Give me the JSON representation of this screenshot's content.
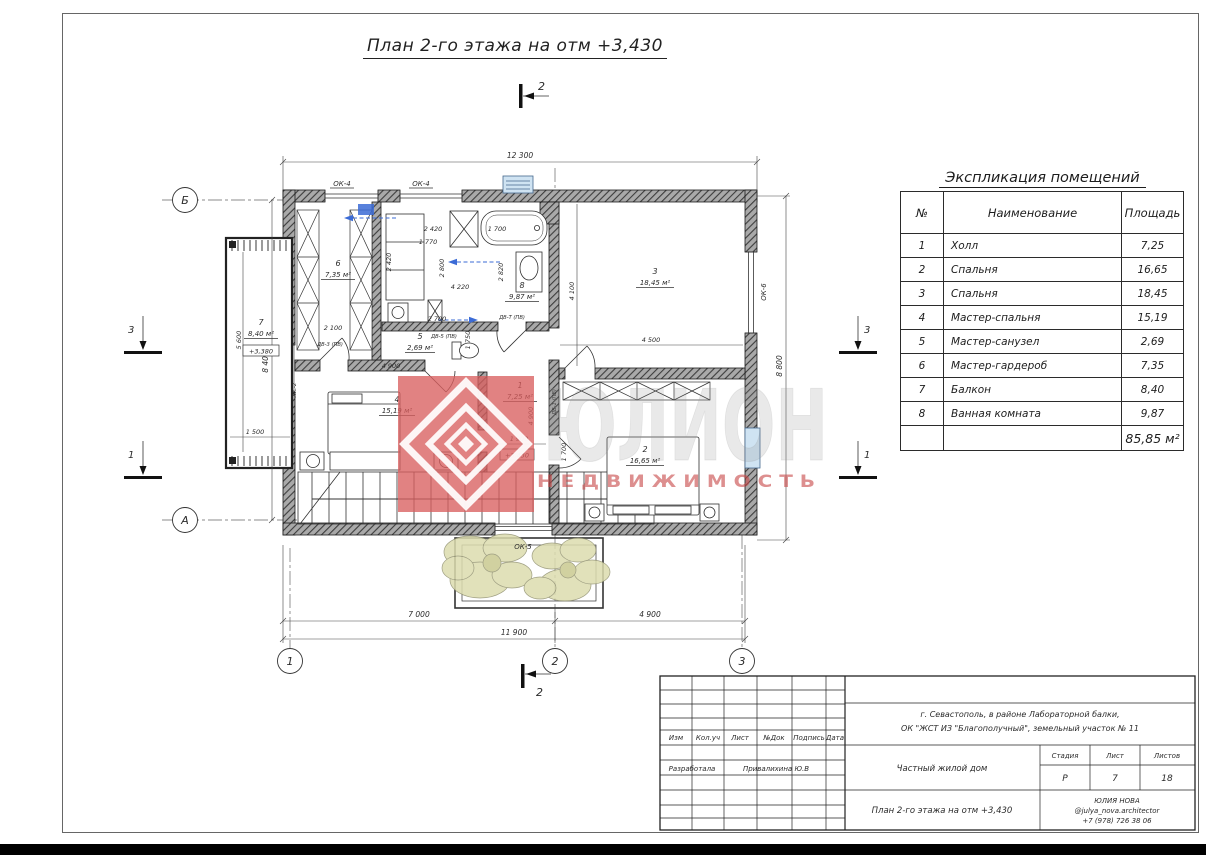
{
  "page": {
    "title": "План 2-го этажа на отм +3,430"
  },
  "watermark": {
    "brand": "ЮЛИОН",
    "subtitle": "Н Е Д В И Ж И М О С Т Ь"
  },
  "explication": {
    "title": "Экспликация помещений",
    "headers": {
      "num": "№",
      "name": "Наименование",
      "area": "Площадь"
    },
    "rows": [
      {
        "num": "1",
        "name": "Холл",
        "area": "7,25"
      },
      {
        "num": "2",
        "name": "Спальня",
        "area": "16,65"
      },
      {
        "num": "3",
        "name": "Спальня",
        "area": "18,45"
      },
      {
        "num": "4",
        "name": "Мастер-спальня",
        "area": "15,19"
      },
      {
        "num": "5",
        "name": "Мастер-санузел",
        "area": "2,69"
      },
      {
        "num": "6",
        "name": "Мастер-гардероб",
        "area": "7,35"
      },
      {
        "num": "7",
        "name": "Балкон",
        "area": "8,40"
      },
      {
        "num": "8",
        "name": "Ванная комната",
        "area": "9,87"
      }
    ],
    "total": "85,85 м²"
  },
  "plan": {
    "rooms": [
      {
        "num": "1",
        "area": "7,25 м²"
      },
      {
        "num": "2",
        "area": "16,65 м²"
      },
      {
        "num": "3",
        "area": "18,45 м²"
      },
      {
        "num": "4",
        "area": "15,19 м²"
      },
      {
        "num": "5",
        "area": "2,69 м²"
      },
      {
        "num": "6",
        "area": "7,35 м²"
      },
      {
        "num": "7",
        "area": "8,40 м²"
      },
      {
        "num": "8",
        "area": "9,87 м²"
      }
    ],
    "axes": {
      "b": "Б",
      "a": "А",
      "n1": "1",
      "n2": "2",
      "n3": "3"
    },
    "sections": {
      "top": "2",
      "bottom": "2",
      "left_top": "3",
      "left_bottom": "1",
      "right_top": "3",
      "right_bottom": "1"
    },
    "windows": [
      "ОК-4",
      "ОК-4",
      "ОК-5",
      "ОК-6"
    ],
    "doors": [
      "ДВ-3 (ПВ)",
      "ДВ-5 (ПВ)",
      "ДВ-Т (ПВ)",
      "ДВ-1 (ПВ)"
    ],
    "misc_label": "ЖС-2",
    "elevations": [
      "+3,430",
      "+3,380"
    ],
    "dims": {
      "overall_top": "12 300",
      "left": "8 400",
      "right": "8 800",
      "bottom_left": "7 000",
      "bottom_right": "4 900",
      "bottom_total": "11 900",
      "interior": [
        "2 420",
        "1 770",
        "2 420",
        "2 800",
        "4 220",
        "2 700",
        "1 700",
        "2 820",
        "2 100",
        "4 100",
        "4 500",
        "4 900",
        "4 900",
        "1 900",
        "1 700",
        "5 600",
        "1 500",
        "1 750"
      ]
    }
  },
  "titleblock": {
    "cols": [
      "Изм",
      "Кол.уч",
      "Лист",
      "№Док",
      "Подпись",
      "Дата"
    ],
    "developer_label": "Разработала",
    "developer_name": "Привалихина Ю.В",
    "address_line1": "г. Севастополь, в районе Лабораторной балки,",
    "address_line2": "ОК \"ЖСТ ИЗ \"Благополучный\", земельный участок № 11",
    "object": "Частный жилой дом",
    "stage_label": "Стадия",
    "sheet_label": "Лист",
    "sheets_label": "Листов",
    "stage": "Р",
    "sheet": "7",
    "sheets": "18",
    "drawing_title": "План 2-го этажа на отм +3,430",
    "author": "ЮЛИЯ НОВА",
    "author_handle": "@julya_nova.architector",
    "author_phone": "+7 (978) 726 38 06"
  }
}
